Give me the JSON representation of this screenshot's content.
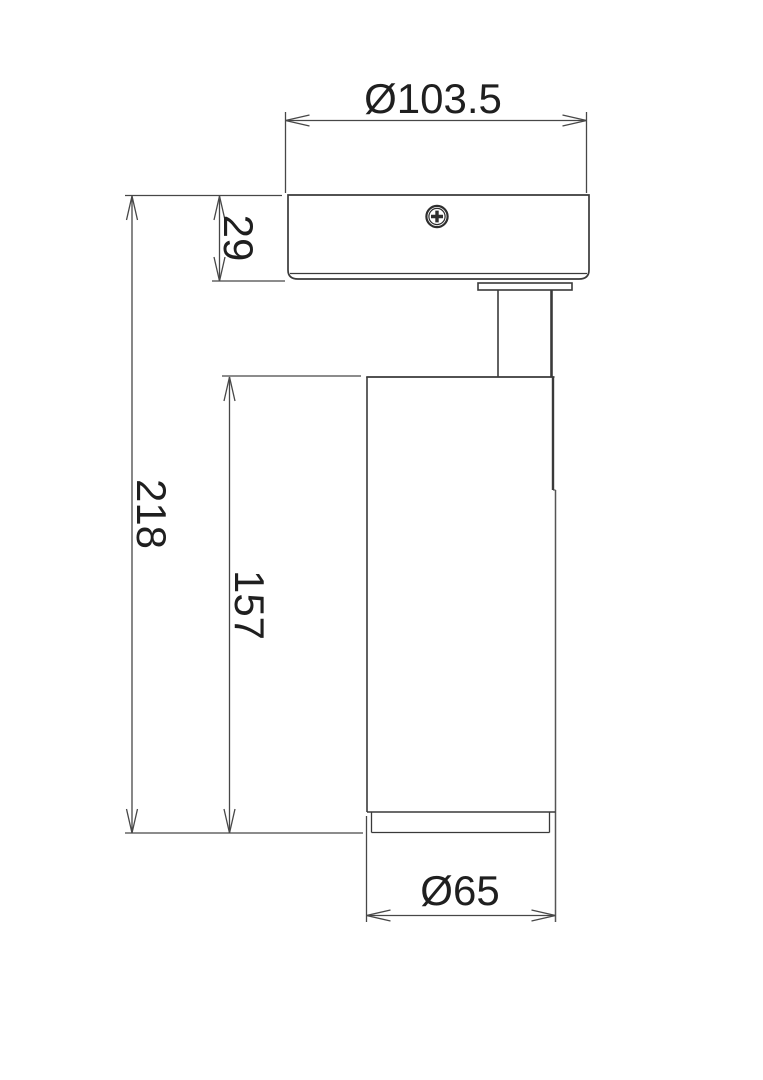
{
  "drawing": {
    "kind": "technical-dimension-drawing",
    "labels": {
      "top_diameter": "Ø103.5",
      "canopy_height": "29",
      "total_height": "218",
      "body_height": "157",
      "body_diameter": "Ø65"
    },
    "values": {
      "top_diameter": 103.5,
      "canopy_height": 29,
      "total_height": 218,
      "body_height": 157,
      "body_diameter": 65
    },
    "colors": {
      "background": "#ffffff",
      "object_line": "#3a3a3a",
      "dimension_line": "#474747",
      "text": "#1f1f1f"
    }
  }
}
